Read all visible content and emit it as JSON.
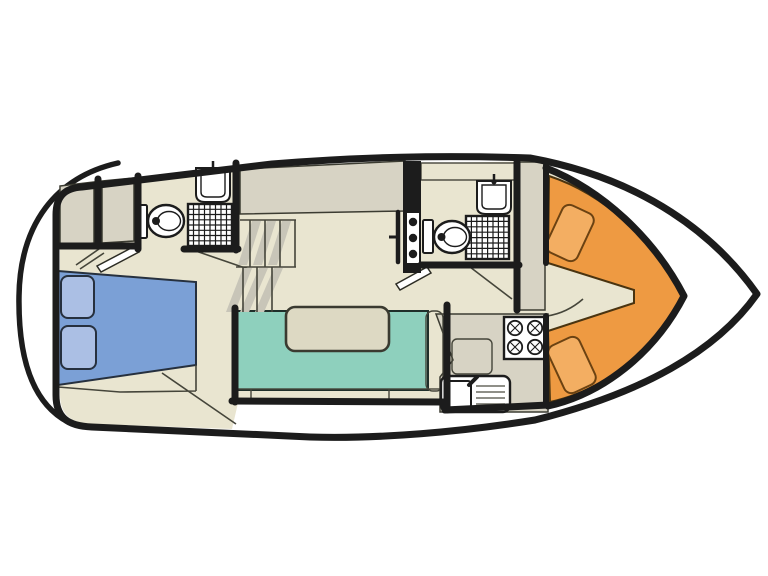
{
  "meta": {
    "type": "boat-deck-floor-plan",
    "canvas_width": 768,
    "canvas_height": 576,
    "orientation": "bow-right"
  },
  "colors": {
    "background": "#ffffff",
    "outline_black": "#1c1c1c",
    "floor_tan": "#e9e5d0",
    "cabinet_gray": "#d7d3c4",
    "shadow_gray": "#c8c5b8",
    "bed_blue": "#7ba0d6",
    "pillow_blue": "#abbfe4",
    "sofa_teal": "#8ed0bd",
    "sofa_teal_dark": "#79c5b2",
    "bolster_tan": "#dfdbc6",
    "table_tan": "#ddd9c3",
    "cockpit_orange": "#ee9a42",
    "cushion_orange": "#f3ae62",
    "fixture_white": "#ffffff"
  },
  "regions": [
    {
      "name": "swim-platform"
    },
    {
      "name": "aft-cabin"
    },
    {
      "name": "wardrobes"
    },
    {
      "name": "aft-bathroom"
    },
    {
      "name": "companionway-stairs"
    },
    {
      "name": "saloon-dinette"
    },
    {
      "name": "galley"
    },
    {
      "name": "forward-bathroom"
    },
    {
      "name": "bow-cockpit"
    }
  ],
  "fixtures": {
    "toilets": 2,
    "washbasins": 2,
    "showers": 2,
    "stove_burners": 4,
    "galley_sink_drainer_lines": 4,
    "bed_pillows": 2,
    "bow_cushions": 2,
    "stair_flights": 2,
    "dinette_tables": 1
  }
}
